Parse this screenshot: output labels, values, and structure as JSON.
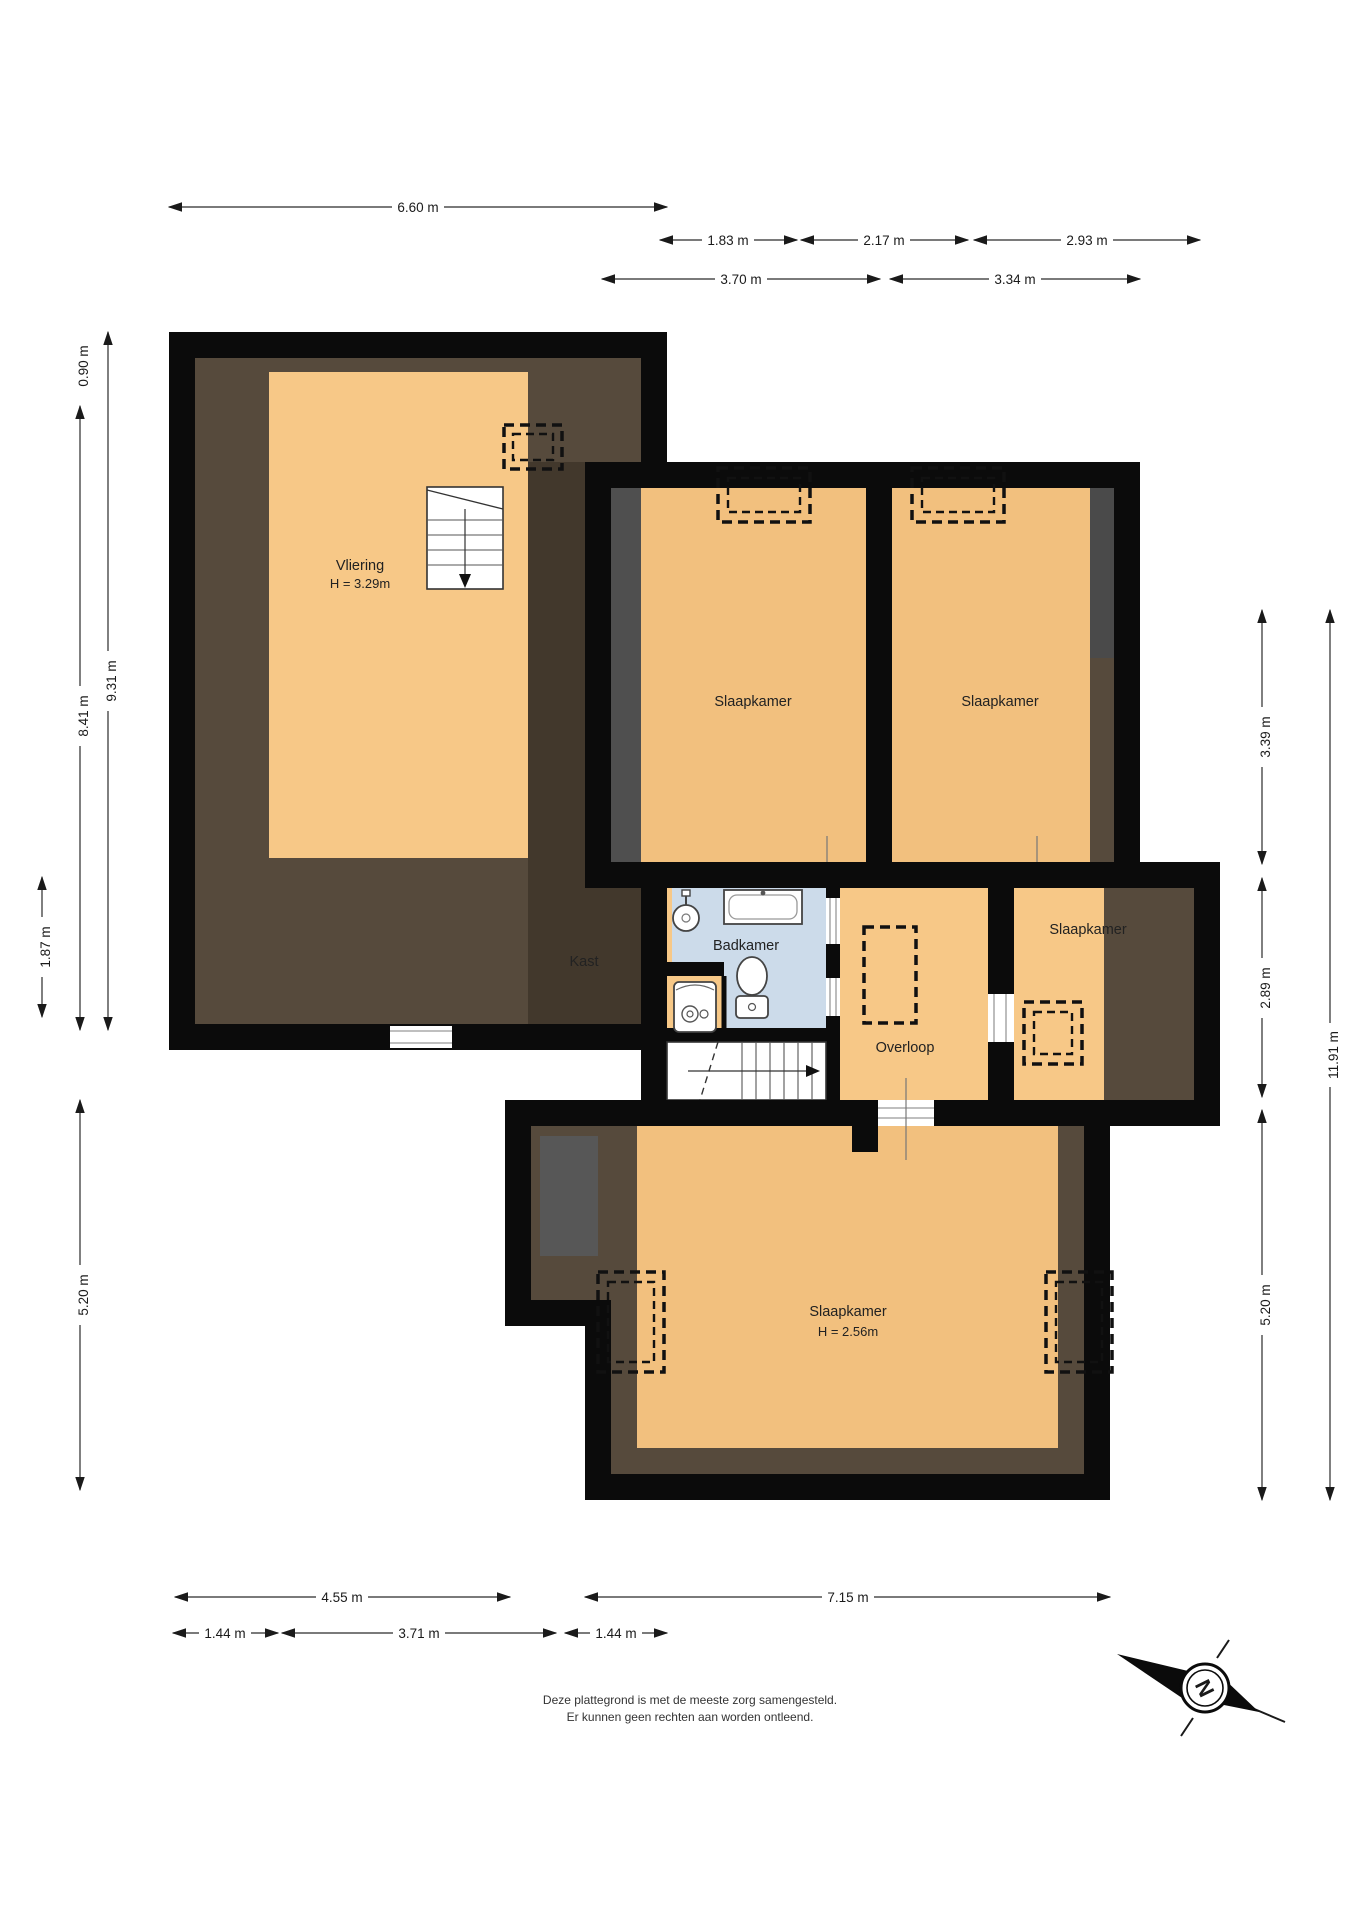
{
  "rooms": {
    "vliering": {
      "label": "Vliering",
      "height": "H = 3.29m"
    },
    "slaapkamer_top_left": {
      "label": "Slaapkamer"
    },
    "slaapkamer_top_right": {
      "label": "Slaapkamer"
    },
    "slaapkamer_mid_right": {
      "label": "Slaapkamer"
    },
    "kast": {
      "label": "Kast"
    },
    "badkamer": {
      "label": "Badkamer"
    },
    "overloop": {
      "label": "Overloop"
    },
    "slaapkamer_bottom": {
      "label": "Slaapkamer",
      "height": "H = 2.56m"
    }
  },
  "dimensions": {
    "top": [
      "6.60 m",
      "1.83 m",
      "2.17 m",
      "2.93 m",
      "3.70 m",
      "3.34 m"
    ],
    "left": [
      "0.90 m",
      "8.41 m",
      "9.31 m",
      "1.87 m",
      "5.20 m"
    ],
    "right": [
      "3.39 m",
      "2.89 m",
      "5.20 m",
      "11.91 m"
    ],
    "bottom": [
      "4.55 m",
      "7.15 m",
      "1.44 m",
      "3.71 m",
      "1.44 m"
    ]
  },
  "footer": {
    "line1": "Deze plattegrond is met de meeste zorg samengesteld.",
    "line2": "Er kunnen geen rechten aan worden ontleend."
  },
  "compass": {
    "north": "N"
  },
  "colors": {
    "wall_black": "#0b0b0b",
    "roof_brown": "#564A3C",
    "roof_gray": "#575757",
    "floor_orange": "#F2C07E",
    "floor_orange_bright": "#F7C887",
    "bathroom_blue": "#CCDBEA",
    "dim_line": "#2b2b2b"
  }
}
